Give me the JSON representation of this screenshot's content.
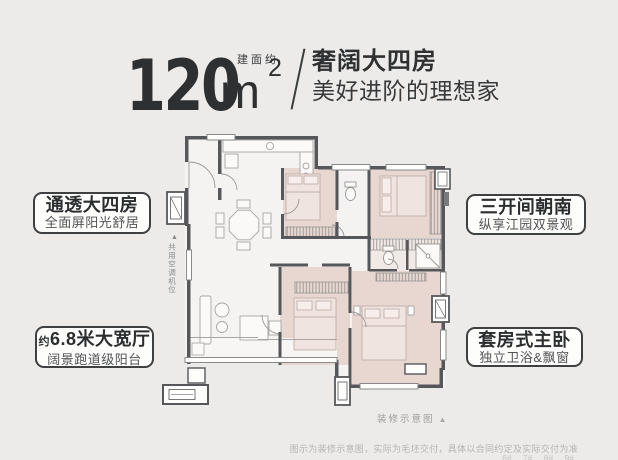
{
  "header": {
    "area_label": "建面约",
    "area_value": "120",
    "area_unit": "m",
    "area_exponent": "2",
    "tagline_line1": "奢阔大四房",
    "tagline_line2": "美好进阶的理想家"
  },
  "callouts": {
    "top_left": {
      "title": "通透大四房",
      "subtitle": "全面屏阳光舒居"
    },
    "bottom_left": {
      "prefix": "约",
      "title": "6.8米大宽厅",
      "subtitle": "阔景跑道级阳台"
    },
    "top_right": {
      "title": "三开间朝南",
      "subtitle": "纵享江园双景观"
    },
    "bottom_right": {
      "title": "套房式主卧",
      "subtitle": "独立卫浴&飘窗"
    }
  },
  "floorplan": {
    "shared_ac_marker": "▲",
    "shared_ac_label": "共用空调机位",
    "caption": "装修示意图",
    "caption_marker": "▲"
  },
  "footer": {
    "disclaimer": "图示为装修示意图，实际为毛坯交付，具体以合同约定及实际交付为准",
    "building_numbers": "6#  7#  8#  9#"
  },
  "colors": {
    "page_bg": "#ECEBE9",
    "wall_dark": "#56575A",
    "room_pink": "#E8D6D1",
    "text_dark": "#2D2F31",
    "muted_gray": "#9C9B99"
  }
}
